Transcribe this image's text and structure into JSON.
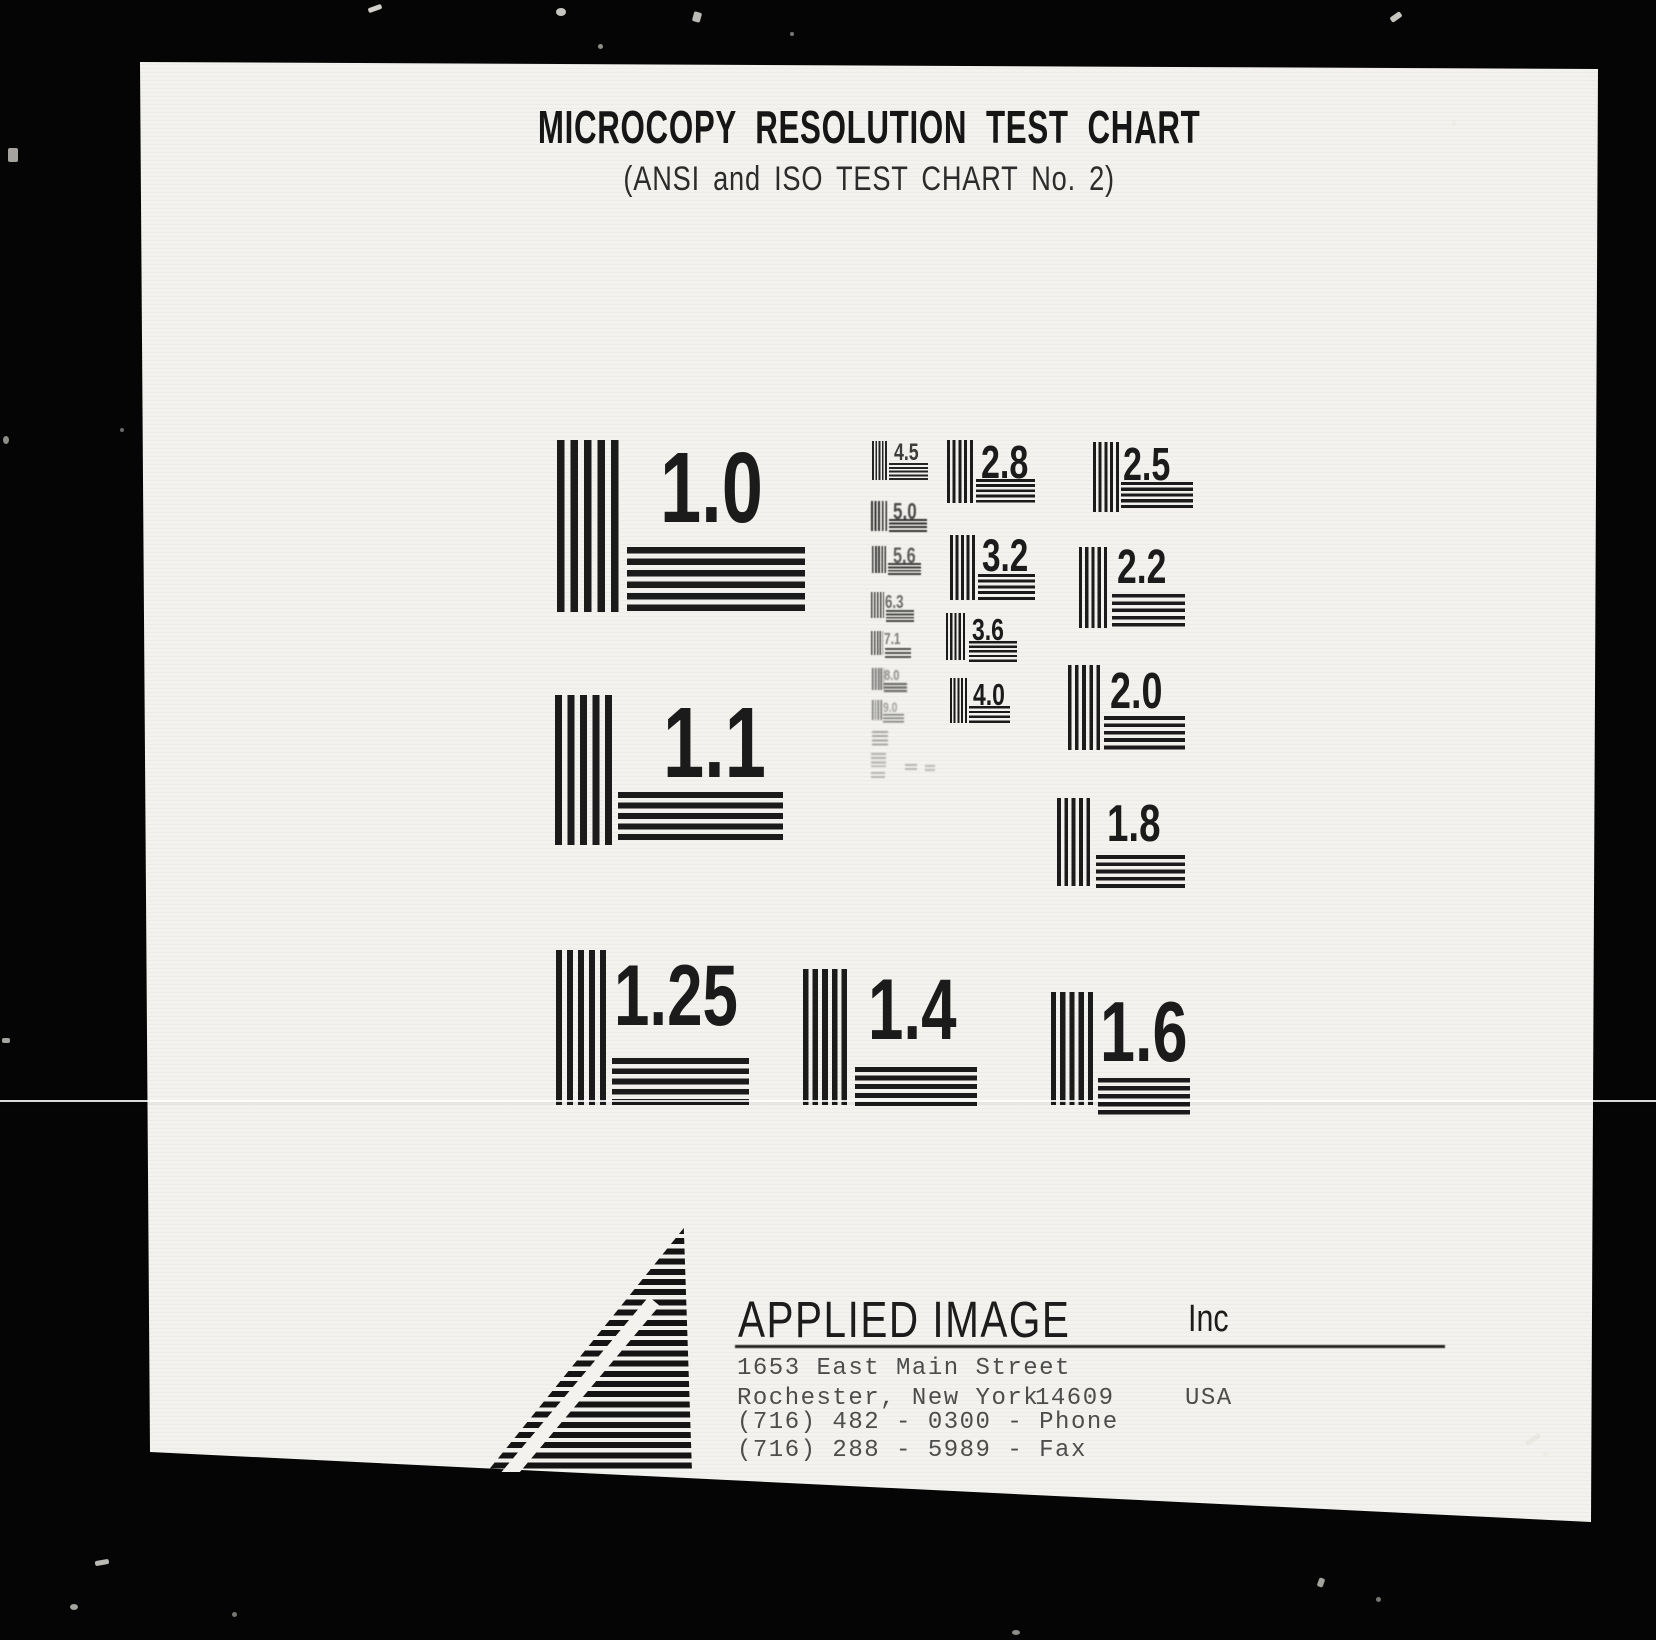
{
  "document": {
    "title": "MICROCOPY RESOLUTION TEST CHART",
    "subtitle": "(ANSI and ISO TEST CHART No. 2)"
  },
  "patterns": {
    "large": [
      {
        "label": "1.0"
      },
      {
        "label": "1.1"
      },
      {
        "label": "1.25"
      },
      {
        "label": "1.4"
      },
      {
        "label": "1.6"
      }
    ],
    "medium": [
      {
        "label": "1.8"
      },
      {
        "label": "2.0"
      },
      {
        "label": "2.2"
      },
      {
        "label": "2.5"
      },
      {
        "label": "2.8"
      },
      {
        "label": "3.2"
      },
      {
        "label": "3.6"
      },
      {
        "label": "4.0"
      }
    ],
    "ladder": [
      {
        "label": "4.5"
      },
      {
        "label": "5.0"
      },
      {
        "label": "5.6"
      },
      {
        "label": "6.3"
      },
      {
        "label": "7.1"
      },
      {
        "label": "8.0"
      },
      {
        "label": "9.0"
      }
    ]
  },
  "footer": {
    "company": "APPLIED IMAGE",
    "company_suffix": "Inc",
    "address_line": "1653 East Main Street",
    "city_line": "Rochester, New York",
    "zip": "14609",
    "country": "USA",
    "phone_line": "(716) 482 - 0300 - Phone",
    "fax_line": "(716) 288 - 5989 - Fax"
  },
  "colors": {
    "ink": "#1b1b1b",
    "paper": "#f3f2ee",
    "background": "#050505"
  }
}
